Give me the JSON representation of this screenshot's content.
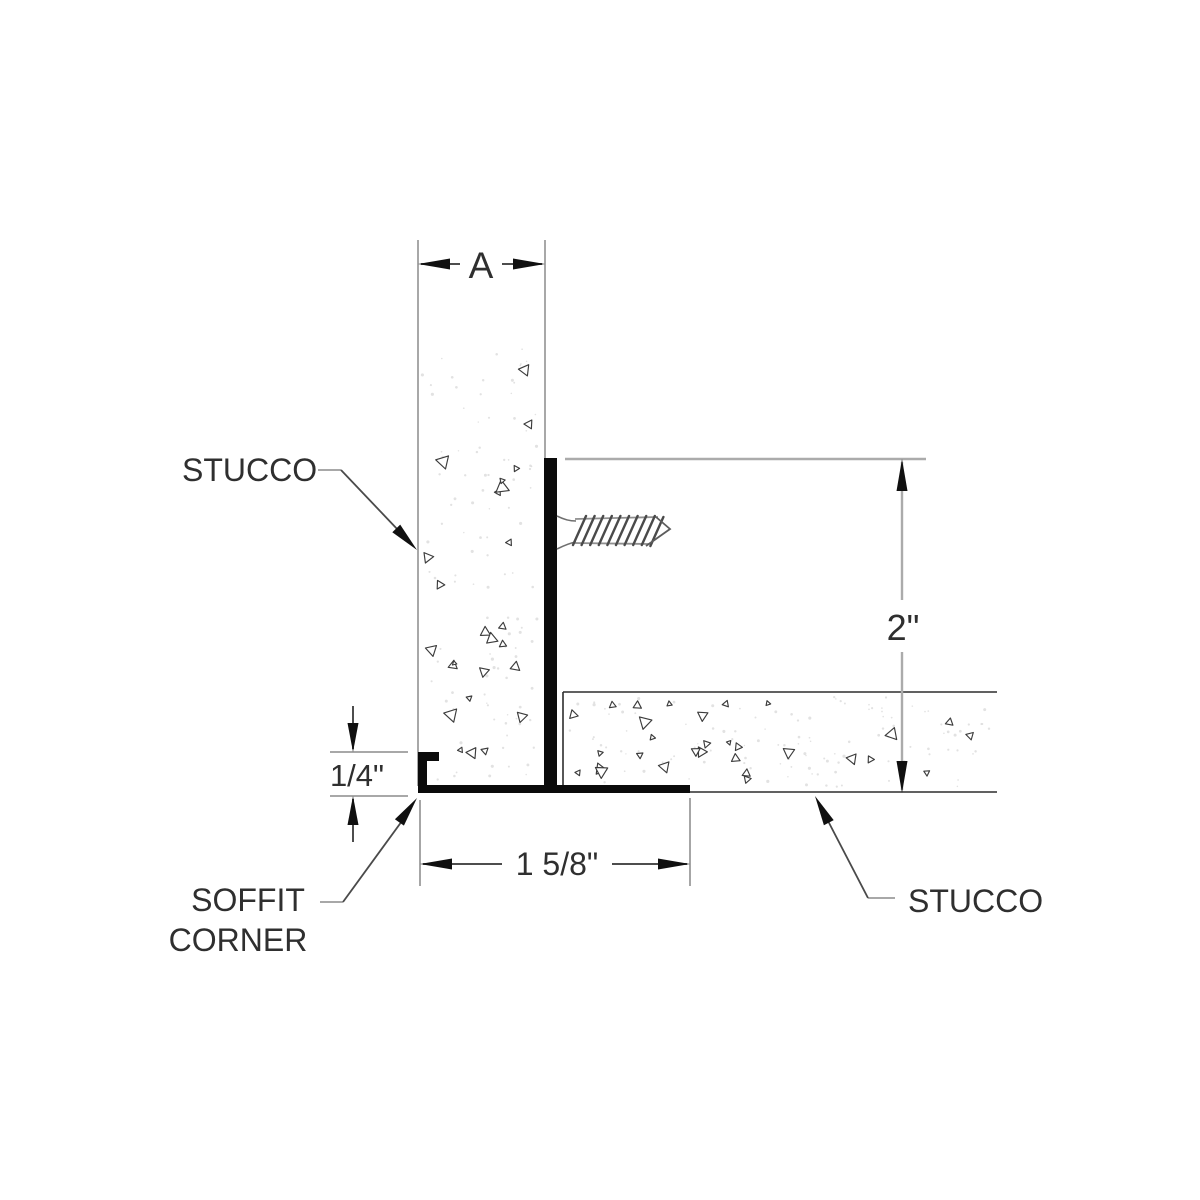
{
  "drawing": {
    "dimensions": {
      "width_label": "A",
      "leg_height": "2\"",
      "flange_width": "1 5/8\"",
      "lip_height": "1/4\""
    },
    "callouts": {
      "stucco_left": "STUCCO",
      "stucco_right": "STUCCO",
      "soffit_corner_line1": "SOFFIT",
      "soffit_corner_line2": "CORNER"
    },
    "colors": {
      "callout_red": "#e02125",
      "ink": "#2f2f2f",
      "dimension_line": "#4d4d4d",
      "extension_gray": "#a8a8a8",
      "profile_black": "#0b0b0b",
      "texture_stroke": "#3c3c3c",
      "stipple_dot": "#d2d2d2",
      "background": "#ffffff"
    }
  }
}
